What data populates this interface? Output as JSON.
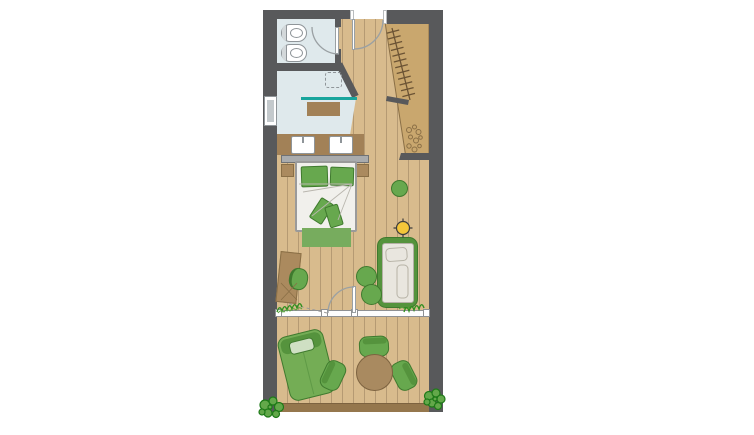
{
  "colors": {
    "wall": "#58595b",
    "jamb": "#ffffff",
    "floor": "#d8bb8d",
    "floor_line": "#b59a73",
    "deck_edge": "#95774d",
    "bath": "#dfe9ec",
    "window_pane": "#c3c9cc",
    "fixture_outline": "#8f9599",
    "glass": "#18a59d",
    "counter": "#a28157",
    "wood": "#ab8a5e",
    "wood_dark": "#8a6f46",
    "closet": "#c9a76e",
    "green": "#67a84e",
    "green_dark": "#3f7a2e",
    "green_deep": "#55933d",
    "cream": "#e9e6df",
    "linen": "#f1f0ec",
    "frame_gray": "#9a9a9a",
    "headboard": "#a9abad",
    "headboard_edge": "#707274",
    "rug": "#77ac5e",
    "yellow": "#f4c63a",
    "ink": "#3c3c3c",
    "grass": "#2f8f1f",
    "bush_fill": "#63a84a",
    "bush_line": "#1e7a18",
    "table": "#a98a60",
    "table_line": "#7d6340",
    "fold": "#b9b6ae"
  },
  "plan": {
    "type": "floor-plan",
    "rooms": [
      {
        "name": "wc",
        "features": [
          "toilet",
          "bidet",
          "swing-door"
        ]
      },
      {
        "name": "bathroom",
        "features": [
          "ceiling-shower",
          "glass-partition",
          "bench",
          "double-washbasin-counter",
          "window"
        ]
      },
      {
        "name": "entry-corridor",
        "features": [
          "entrance-door",
          "wardrobe-with-hanger-rail",
          "niche-with-shelf",
          "pebble-decor"
        ]
      },
      {
        "name": "bedroom-living",
        "features": [
          "double-bed",
          "pillows",
          "cushions",
          "rug",
          "nightstands",
          "headboard-shelf",
          "daybed",
          "two-poufs",
          "stool",
          "desk",
          "desk-chair",
          "ceiling-light-symbol",
          "terrace-door",
          "glazed-front",
          "indoor-plants"
        ]
      },
      {
        "name": "terrace",
        "features": [
          "sun-lounger",
          "round-dining-table",
          "three-chairs",
          "wood-deck",
          "bushes"
        ]
      }
    ]
  }
}
